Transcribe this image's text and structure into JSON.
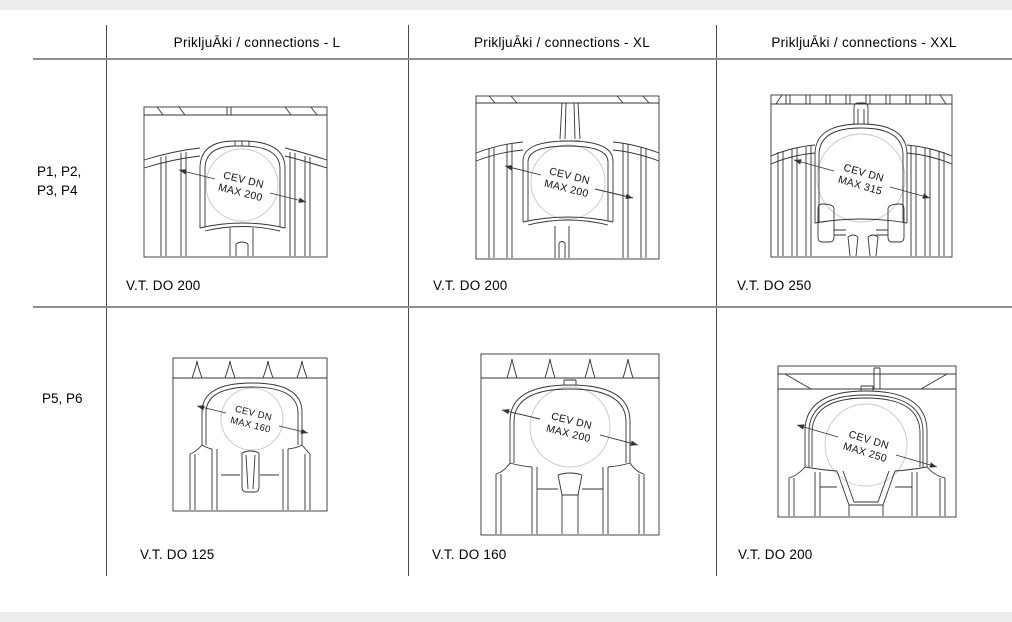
{
  "colors": {
    "drawing_line": "#333333",
    "circle_line": "#c6c6c6",
    "grid_line_v": "#4a4a4a",
    "grid_line_h": "#8f8f8f",
    "frame_strip": "#ececec",
    "text": "#111111"
  },
  "table": {
    "col_headers": [
      "PrikljuĀki / connections - L",
      "PrikljuĀki / connections - XL",
      "PrikljuĀki / connections - XXL"
    ]
  },
  "rows": [
    {
      "label_lines": [
        "P1, P2,",
        "P3, P4"
      ],
      "cells": [
        {
          "dim_line1": "CEV DN",
          "dim_line2": "MAX 200",
          "caption": "V.T. DO 200"
        },
        {
          "dim_line1": "CEV DN",
          "dim_line2": "MAX 200",
          "caption": "V.T. DO 200"
        },
        {
          "dim_line1": "CEV DN",
          "dim_line2": "MAX 315",
          "caption": "V.T. DO 250"
        }
      ]
    },
    {
      "label_lines": [
        "P5, P6"
      ],
      "cells": [
        {
          "dim_line1": "CEV DN",
          "dim_line2": "MAX 160",
          "caption": "V.T. DO 125"
        },
        {
          "dim_line1": "CEV DN",
          "dim_line2": "MAX 200",
          "caption": "V.T. DO 160"
        },
        {
          "dim_line1": "CEV DN",
          "dim_line2": "MAX 250",
          "caption": "V.T. DO 200"
        }
      ]
    }
  ]
}
